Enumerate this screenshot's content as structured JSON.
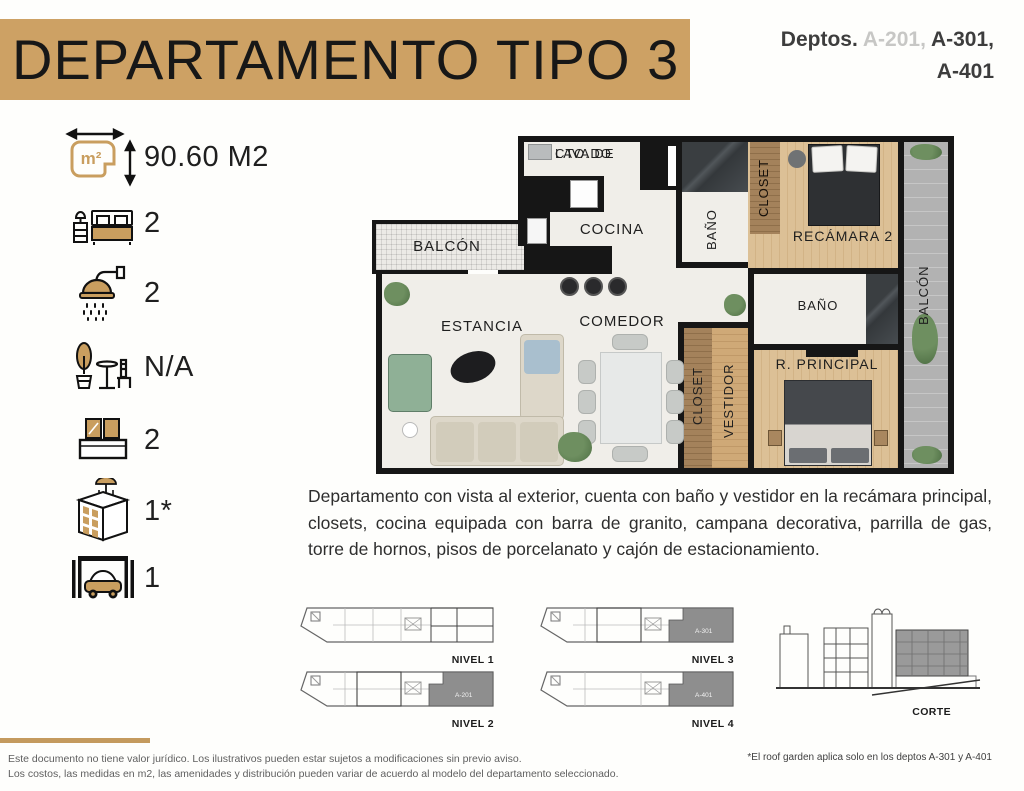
{
  "header": {
    "title": "DEPARTAMENTO TIPO 3",
    "deptos_prefix": "Deptos.",
    "depto_muted": "A-201,",
    "depto_strong": "A-301,",
    "depto_strong2": "A-401",
    "banner_color": "#CDA164"
  },
  "specs": {
    "accent_color": "#C99E5F",
    "items": [
      {
        "icon": "area-icon",
        "value": "90.60 M2"
      },
      {
        "icon": "bedroom-icon",
        "value": "2"
      },
      {
        "icon": "bathroom-icon",
        "value": "2"
      },
      {
        "icon": "terrace-icon",
        "value": "N/A"
      },
      {
        "icon": "balcony-icon",
        "value": "2"
      },
      {
        "icon": "roof-garden-icon",
        "value": "1*"
      },
      {
        "icon": "parking-icon",
        "value": "1"
      }
    ]
  },
  "floorplan": {
    "rooms": {
      "laundry_line1": "CTO. DE",
      "laundry_line2": "LAVADO",
      "kitchen": "COCINA",
      "balcony_left": "BALCÓN",
      "bathroom1": "BAÑO",
      "closet1": "CLOSET",
      "bedroom2": "RECÁMARA 2",
      "balcony_right": "BALCÓN",
      "bathroom2": "BAÑO",
      "living": "ESTANCIA",
      "dining": "COMEDOR",
      "closet2": "CLOSET",
      "dressing": "VESTIDOR",
      "master": "R. PRINCIPAL"
    }
  },
  "description": {
    "text": "Departamento con vista al exterior, cuenta con baño y vestidor en la recámara principal, closets, cocina equipada con barra de granito, campana decorativa, parrilla de gas, torre de hornos, pisos de porcelanato y cajón de estacionamiento."
  },
  "levels": {
    "nivel1": {
      "label": "NIVEL 1",
      "unit": ""
    },
    "nivel2": {
      "label": "NIVEL 2",
      "unit": "A-201"
    },
    "nivel3": {
      "label": "NIVEL 3",
      "unit": "A-301"
    },
    "nivel4": {
      "label": "NIVEL 4",
      "unit": "A-401"
    },
    "corte": {
      "label": "CORTE"
    }
  },
  "footer": {
    "disclaimer_line1": "Este documento no tiene valor jurídico. Los ilustrativos pueden estar sujetos a modificaciones sin previo aviso.",
    "disclaimer_line2": "Los costos, las medidas en m2, las amenidades y distribución pueden variar de acuerdo al modelo del departamento seleccionado.",
    "roof_note": "*El roof garden aplica solo en los deptos A-301 y A-401"
  }
}
